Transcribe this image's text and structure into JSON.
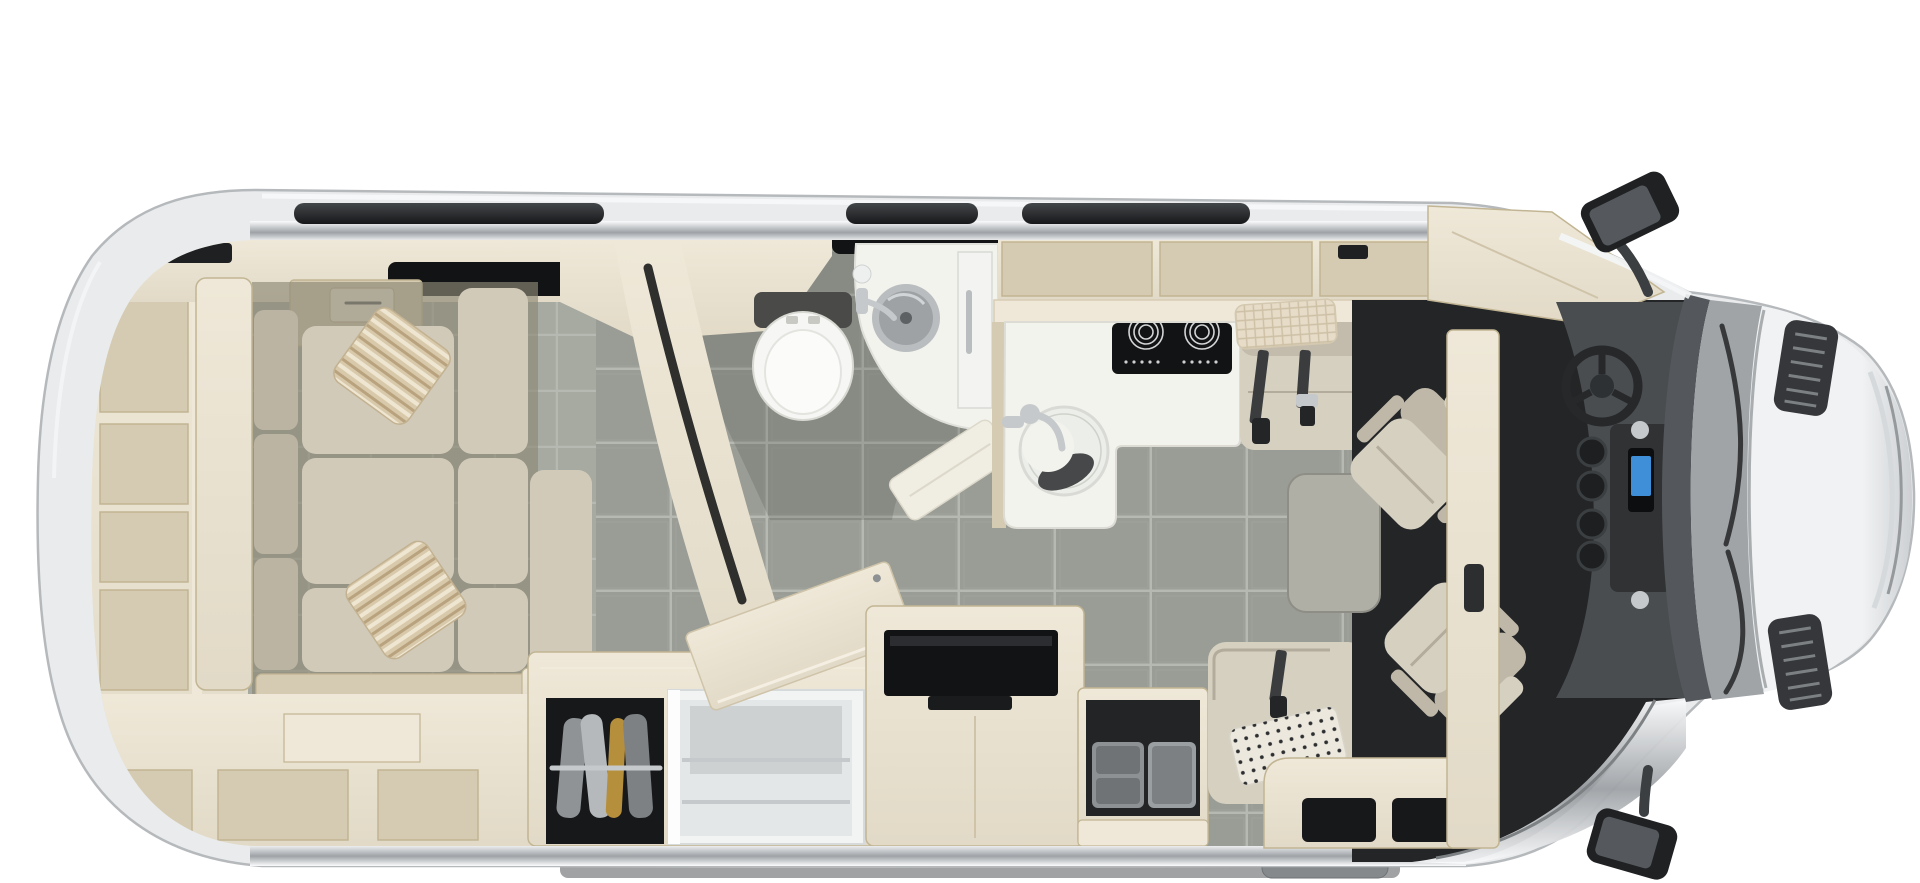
{
  "page": {
    "title": "Motorhome floor plan — overhead cutaway view",
    "background": "#ffffff"
  },
  "palette": {
    "body": "#e9ebec",
    "body_edge": "#b6b9bc",
    "silver_hi": "#fafbfc",
    "silver_lo": "#9ea2a6",
    "wood_hi": "#efe8d8",
    "wood": "#e2dac7",
    "wood_mid": "#d5cab2",
    "wood_dark": "#c2b593",
    "floor": "#e8e2d4",
    "tile_aisle": "#9a9d95",
    "tile_lounge": "#a7aaa1",
    "grout": "#b6b9b1",
    "bath_shade": "#4a4c47",
    "cushion": "#d1cab9",
    "cushion_dark": "#bcb4a3",
    "seam": "#8e8877",
    "pillow": "#d8c9ab",
    "pillow_stripe": "#b9a27e",
    "counter": "#f3f3ee",
    "white": "#f8f9f8",
    "dark": "#1e2022",
    "near_black": "#121314",
    "chrome": "#c6c9cb",
    "steel": "#8d9194",
    "table": "#b0afa6",
    "seat": "#d6d0c1",
    "seat_dark": "#bfb8a8",
    "dash": "#4a4d50",
    "cab_floor": "#232527",
    "glass": "#54585c",
    "cowl": "#a0a4a7",
    "hood_hi": "#f0f2f3",
    "hood_lo": "#cdd0d3",
    "screen_blue": "#3e8ed8",
    "mustard": "#b68f3c",
    "belt": "#3a3c3e",
    "shadow": "#2e3032"
  },
  "labels": {
    "vehicle": "Motorhome top view",
    "coach_body": "Coach body shell",
    "roof_awning": "Roof awning rail",
    "roof_vent_a": "Roof vent",
    "roof_vent_b": "Roof vent",
    "rear_shelving": "Rear wardrobe shelving",
    "rear_tv": "Rear wall TV",
    "lounge_window": "Lounge window",
    "overhead_cabinet_rear": "Rear overhead cabinet with drawer",
    "rear_lounge_sofa": "Rear lounge sectional sofa",
    "throw_pillow_1": "Striped throw pillow",
    "throw_pillow_2": "Striped throw pillow",
    "under_sofa_storage": "Under-sofa storage cubbies",
    "bathroom_floor": "Bathroom floor",
    "pocket_door_wall": "Curved bathroom pocket-door wall",
    "toilet": "Toilet",
    "bath_counter": "Corner bathroom vanity",
    "bath_sink": "Bathroom sink",
    "bath_faucet": "Bathroom faucet",
    "shower_divider": "Shower divider panel",
    "shower_panel": "Folding shower screen",
    "bathroom_window": "Bathroom window",
    "wardrobe": "Wardrobe with hanging clothes",
    "refrigerator": "Refrigerator",
    "counter_flip_lid": "Flip-up counter extension",
    "tv_cabinet": "TV cabinet",
    "tv": "Television",
    "cutlery_drawer": "Open storage drawer with trays",
    "entry_bench": "Entry-side bench seat",
    "entry_pillow": "Dotted accent pillow",
    "entry_cabinet": "Entry step cabinet",
    "kitchen_overhead": "Kitchen overhead cabinets",
    "kitchen_counter": "Galley countertop",
    "cooktop": "Two-burner induction cooktop",
    "kitchen_sink": "Round kitchen sink",
    "kitchen_faucet": "Kitchen faucet",
    "forward_bench": "Forward-facing belted bench seat",
    "seat_belts": "Seat belts",
    "bench_blanket": "Woven throw blanket",
    "pedestal_table": "Removable pedestal table",
    "driver_seat": "Swiveled driver captain seat",
    "passenger_seat": "Swiveled passenger captain seat",
    "cab_partition": "Cab-side wardrobe pillar",
    "overcab_bunk": "Over-cab cabinet",
    "cab_floor": "Cab floor",
    "entry_sill": "Entry door sill",
    "entry_step": "Electric entry step",
    "dashboard": "Dashboard",
    "steering_wheel": "Steering wheel",
    "center_console": "Center console with cup holders",
    "infotainment": "Infotainment screen",
    "windshield": "Windshield",
    "cowl": "Wiper cowl",
    "wiper": "Windshield wiper",
    "hood": "Hood",
    "hood_vent_top": "Hood vent grille",
    "hood_vent_bottom": "Hood vent grille",
    "mirror_top": "Side mirror (driver side)",
    "mirror_bottom": "Side mirror (passenger side)",
    "ground_shadow": "Under-body shadow"
  }
}
